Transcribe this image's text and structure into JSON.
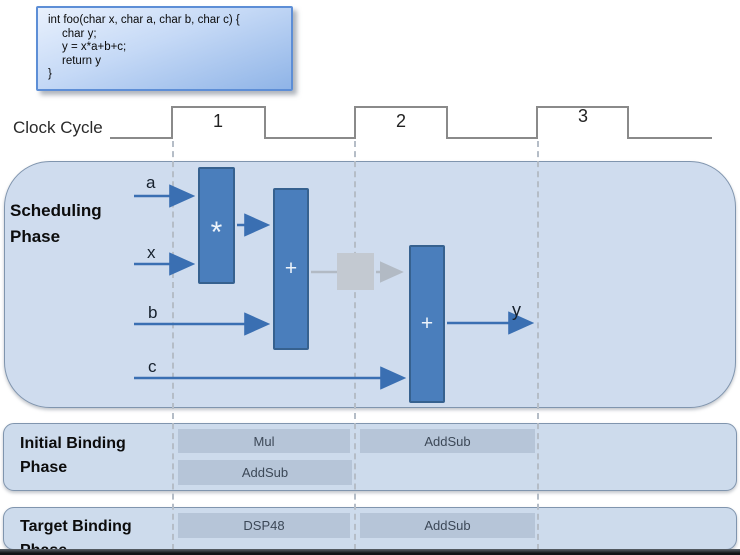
{
  "code_box": {
    "lines": [
      "int foo(char x, char a, char b, char c) {",
      "char y;",
      "y = x*a+b+c;",
      "return y",
      "}"
    ]
  },
  "clock": {
    "label": "Clock Cycle",
    "cycles": [
      "1",
      "2",
      "3"
    ]
  },
  "scheduling": {
    "title_line1": "Scheduling",
    "title_line2": "Phase",
    "inputs": [
      "a",
      "x",
      "b",
      "c"
    ],
    "output_label": "y",
    "operators": [
      {
        "name": "multiplier",
        "symbol": "*"
      },
      {
        "name": "adder-1",
        "symbol": "+"
      },
      {
        "name": "adder-2",
        "symbol": "+"
      }
    ]
  },
  "initial_binding": {
    "title_line1": "Initial Binding",
    "title_line2": "Phase",
    "boxes": [
      {
        "label": "Mul",
        "cycle": 1
      },
      {
        "label": "AddSub",
        "cycle": 2
      },
      {
        "label": "AddSub",
        "cycle": 1
      }
    ]
  },
  "target_binding": {
    "title_line1": "Target Binding",
    "title_line2": "Phase",
    "boxes": [
      {
        "label": "DSP48",
        "cycle": 1
      },
      {
        "label": "AddSub",
        "cycle": 2
      }
    ]
  },
  "colors": {
    "operator_block_fill": "#4a7ebc",
    "operator_block_border": "#36618f",
    "panel_fill": "#cfdcee",
    "panel_border": "#8095ae",
    "binding_box_fill": "#b6c5d8",
    "arrow_blue": "#3a6fb2",
    "register_gray": "#c3c9d1",
    "waveform_gray": "#8a8a8a",
    "code_box_border": "#5d8ed6"
  }
}
